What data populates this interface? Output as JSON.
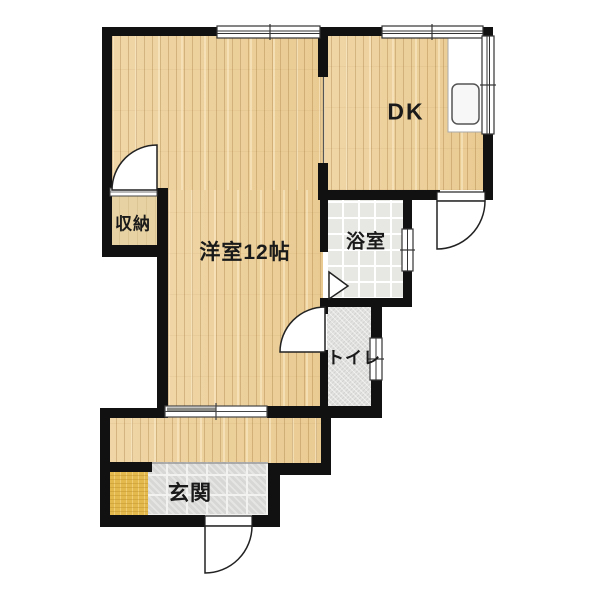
{
  "plan": {
    "type": "apartment-floor-plan",
    "rooms": {
      "main": {
        "label": "洋室12帖"
      },
      "dk": {
        "label": "DK"
      },
      "bath": {
        "label": "浴室"
      },
      "toilet": {
        "label": "トイレ"
      },
      "closet": {
        "label": "収納"
      },
      "entrance": {
        "label": "玄関"
      }
    },
    "fixtures": {
      "kitchen_sink": "kitchen-sink",
      "sliding_door": "sliding-double-door",
      "windows": [
        "top-left-window",
        "top-right-window",
        "dk-side-window",
        "bath-window",
        "toilet-window"
      ],
      "swing_doors": [
        "closet-door",
        "toilet-door",
        "bath-door",
        "dk-exterior-door",
        "entrance-door"
      ]
    },
    "colors": {
      "wall": "#111111",
      "wood_floor": "#eed2a0",
      "closet_floor": "#e6d2a2",
      "bath_tile": "#eaeae8",
      "toilet_floor": "#e2e2e0",
      "genkan_tile": "#d7d7d5",
      "entrance_mat": "#e3b94e",
      "background": "#ffffff",
      "text": "#1a1a1a"
    }
  }
}
